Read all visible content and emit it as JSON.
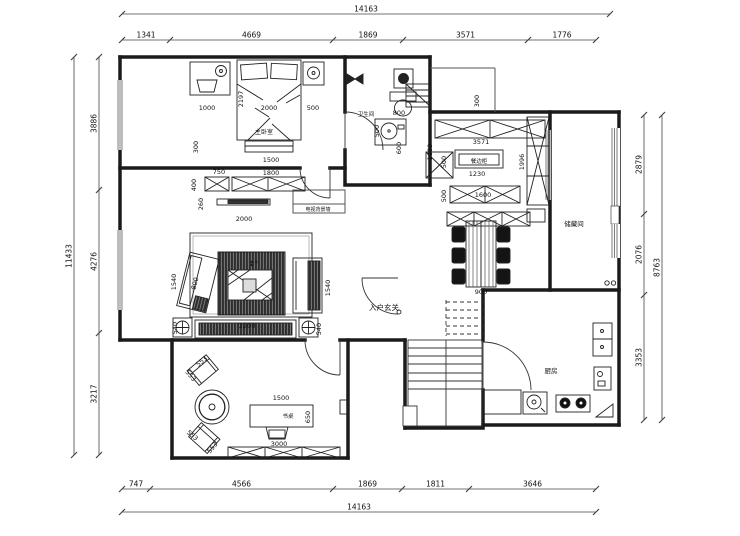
{
  "canvas": {
    "width": 740,
    "height": 536,
    "background": "#ffffff",
    "line_color": "#1b1b1b",
    "text_color": "#111111"
  },
  "dimensions": {
    "top_overall": "14163",
    "top_segments": [
      "1341",
      "4669",
      "1869",
      "3571",
      "1776"
    ],
    "bottom_overall": "14163",
    "bottom_segments": [
      "747",
      "4566",
      "1869",
      "1811",
      "3646"
    ],
    "left_overall": "11433",
    "left_segments": [
      "3886",
      "4276",
      "3217"
    ],
    "right_overall": "8763",
    "right_segments": [
      "2879",
      "2076",
      "3353"
    ]
  },
  "rooms": [
    {
      "label": "主卧室",
      "x": 264,
      "y": 134,
      "size": 6
    },
    {
      "label": "卫生间",
      "x": 366,
      "y": 116,
      "size": 5.5
    },
    {
      "label": "电视背景墙",
      "x": 318,
      "y": 211,
      "size": 5
    },
    {
      "label": "入户玄关",
      "x": 384,
      "y": 310,
      "size": 7.5
    },
    {
      "label": "餐边柜",
      "x": 479,
      "y": 163,
      "size": 5.5
    },
    {
      "label": "储藏间",
      "x": 574,
      "y": 226,
      "size": 6.5
    },
    {
      "label": "厨房",
      "x": 551,
      "y": 373,
      "size": 6.5
    },
    {
      "label": "书桌",
      "x": 288,
      "y": 418,
      "size": 5.5
    }
  ],
  "interior_dims": [
    {
      "t": "1000",
      "x": 207,
      "y": 110
    },
    {
      "t": "2197",
      "x": 243,
      "y": 99,
      "r": -90
    },
    {
      "t": "2000",
      "x": 269,
      "y": 110
    },
    {
      "t": "500",
      "x": 313,
      "y": 110
    },
    {
      "t": "1500",
      "x": 271,
      "y": 162
    },
    {
      "t": "300",
      "x": 198,
      "y": 147,
      "r": -90
    },
    {
      "t": "750",
      "x": 219,
      "y": 174
    },
    {
      "t": "1800",
      "x": 271,
      "y": 175
    },
    {
      "t": "400",
      "x": 196,
      "y": 185,
      "r": -90
    },
    {
      "t": "260",
      "x": 203,
      "y": 204,
      "r": -90
    },
    {
      "t": "2000",
      "x": 244,
      "y": 221
    },
    {
      "t": "1540",
      "x": 176,
      "y": 282,
      "r": -90
    },
    {
      "t": "800",
      "x": 197,
      "y": 284,
      "r": -75
    },
    {
      "t": "1540",
      "x": 330,
      "y": 288,
      "r": -90
    },
    {
      "t": "540",
      "x": 177,
      "y": 328,
      "r": -90
    },
    {
      "t": "2200",
      "x": 247,
      "y": 328
    },
    {
      "t": "540",
      "x": 321,
      "y": 329,
      "r": -90
    },
    {
      "t": "800",
      "x": 399,
      "y": 115
    },
    {
      "t": "500",
      "x": 379,
      "y": 131,
      "r": -90
    },
    {
      "t": "600",
      "x": 401,
      "y": 148,
      "r": -90
    },
    {
      "t": "1009",
      "x": 432,
      "y": 152,
      "r": -90
    },
    {
      "t": "300",
      "x": 479,
      "y": 101,
      "r": -90
    },
    {
      "t": "3571",
      "x": 481,
      "y": 144
    },
    {
      "t": "500",
      "x": 446,
      "y": 162,
      "r": -90
    },
    {
      "t": "1230",
      "x": 477,
      "y": 176
    },
    {
      "t": "1600",
      "x": 483,
      "y": 197
    },
    {
      "t": "500",
      "x": 446,
      "y": 196,
      "r": -90
    },
    {
      "t": "1996",
      "x": 524,
      "y": 162,
      "r": -90
    },
    {
      "t": "900",
      "x": 481,
      "y": 294
    },
    {
      "t": "1500",
      "x": 281,
      "y": 400
    },
    {
      "t": "650",
      "x": 310,
      "y": 417,
      "r": -90
    },
    {
      "t": "3000",
      "x": 279,
      "y": 446
    },
    {
      "t": "553",
      "x": 203,
      "y": 363,
      "r": -40
    },
    {
      "t": "553",
      "x": 189,
      "y": 377,
      "r": 50
    },
    {
      "t": "553",
      "x": 191,
      "y": 437,
      "r": 40
    },
    {
      "t": "553",
      "x": 214,
      "y": 449,
      "r": -50
    }
  ]
}
